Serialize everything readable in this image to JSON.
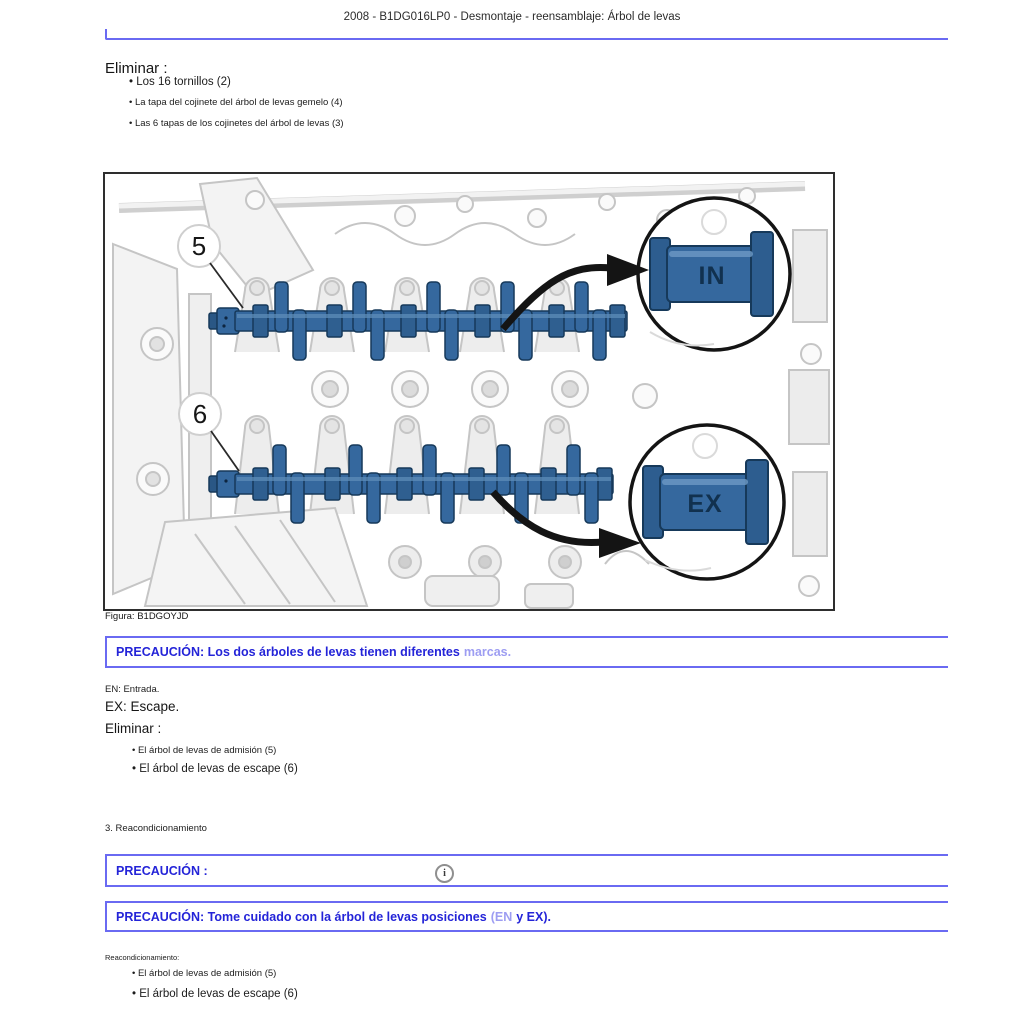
{
  "header": {
    "title": "2008 - B1DG016LP0 - Desmontaje - reensamblaje: Árbol de levas"
  },
  "remove_section_1": {
    "heading": "Eliminar :",
    "bullets": [
      "Los 16 tornillos (2)",
      "La tapa del cojinete del árbol de levas gemelo (4)",
      "Las 6 tapas de los cojinetes del árbol de levas (3)"
    ]
  },
  "figure": {
    "caption": "Figura: B1DGOYJD",
    "callout_number_intake": "5",
    "callout_number_exhaust": "6",
    "mark_intake": "IN",
    "mark_exhaust": "EX",
    "colors": {
      "camshaft_blue": "#35689e",
      "camshaft_dark": "#16395a",
      "line_art_gray": "#c5c5c5",
      "callout_ring": "#141414"
    }
  },
  "caution_marks": {
    "text": "PRECAUCIÓN: Los dos árboles de levas tienen diferentes",
    "link": "marcas."
  },
  "legend": {
    "en_line": "EN: Entrada.",
    "ex_line": "EX: Escape."
  },
  "remove_section_2": {
    "heading": "Eliminar :",
    "bullets": [
      "El árbol de levas de admisión (5)",
      "El árbol de levas de escape (6)"
    ]
  },
  "step": {
    "label": "3. Reacondicionamiento"
  },
  "caution_blank": {
    "text": "PRECAUCIÓN :"
  },
  "icons": {
    "info": "i"
  },
  "caution_positions": {
    "text": "PRECAUCIÓN: Tome cuidado con la árbol de levas posiciones",
    "muted": "(EN",
    "tail": "y EX)."
  },
  "recondition_section": {
    "heading": "Reacondicionamiento:",
    "bullets": [
      "El árbol de levas de admisión (5)",
      "El árbol de levas de escape (6)"
    ]
  },
  "ui_colors": {
    "caution_border": "#6a6af2",
    "caution_text": "#2424d8",
    "caution_link": "#9d9df2"
  }
}
